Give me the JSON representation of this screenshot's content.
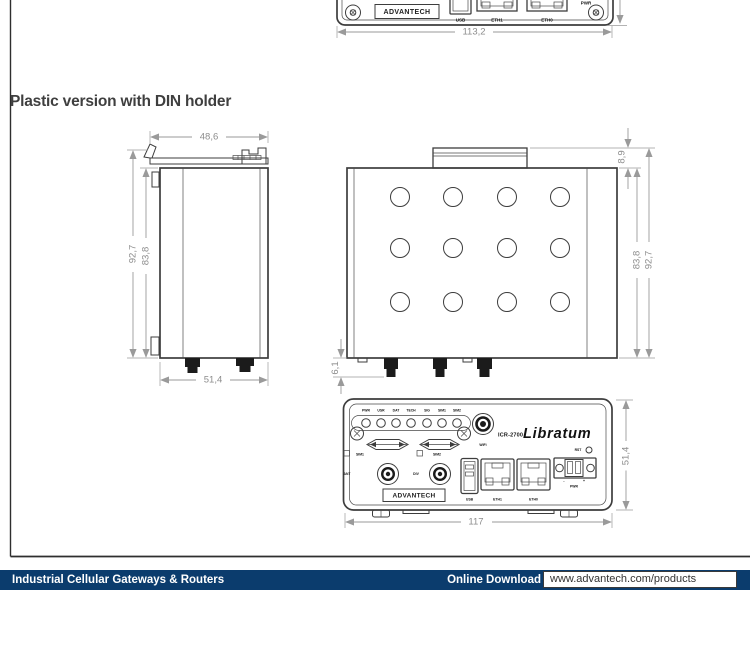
{
  "page": {
    "heading": "Plastic version with DIN holder"
  },
  "colors": {
    "footer_navy": "#0B3C6D",
    "drawing_line": "#3D3D3D",
    "dimension_gray": "#8C8C8C"
  },
  "top_drawing": {
    "logo": "ADVANTECH",
    "usb_label": "USB",
    "eth1_label": "ETH1",
    "eth0_label": "ETH0",
    "pwr_label": "PWR",
    "dim_width": "113,2"
  },
  "side_view": {
    "dim_top_width": "48,6",
    "dim_outer_height": "92,7",
    "dim_inner_height": "83,8",
    "dim_bottom_width": "51,4"
  },
  "top_view": {
    "dim_clip_height": "8,9",
    "dim_inner_height": "83,8",
    "dim_outer_height": "92,7",
    "dim_connector_height": "6,1"
  },
  "front_view": {
    "leds": [
      "PWR",
      "USR",
      "DAT",
      "TECH",
      "SIG",
      "SIM1",
      "SIM2"
    ],
    "wifi_label": "WiFi",
    "model": "ICR-2700",
    "product_name": "Libratum",
    "sim1_label": "SIM1",
    "sim2_label": "SIM2",
    "ant_label": "ANT",
    "div_label": "DIV",
    "logo": "ADVANTECH",
    "usb_label": "USB",
    "eth1_label": "ETH1",
    "eth0_label": "ETH0",
    "rst_label": "RST",
    "pwr_label": "PWR",
    "plus": "+",
    "minus": "-",
    "dim_width": "117",
    "dim_height": "51,4"
  },
  "footer": {
    "left_title": "Industrial Cellular Gateways & Routers",
    "download_label": "Online Download",
    "url": "www.advantech.com/products"
  }
}
